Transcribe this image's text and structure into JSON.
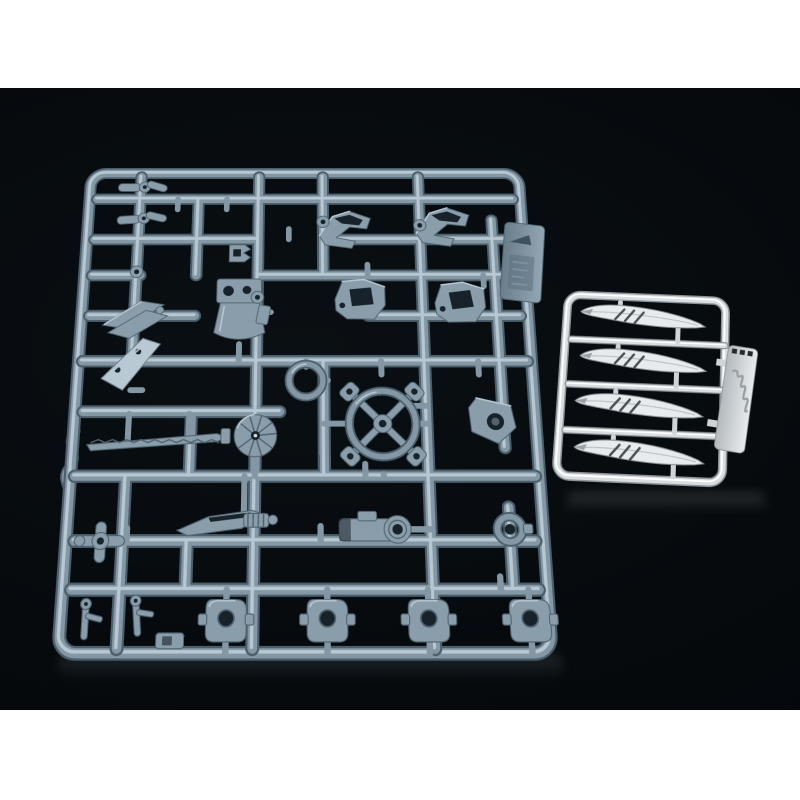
{
  "scene": {
    "subject": "plastic model kit runner sprues photographed on a glossy black backdrop",
    "setting": "black photo area framed by white page background"
  },
  "colors": {
    "page_white": "#ffffff",
    "backdrop_black": "#05090c",
    "rail_shadow": "#4b5e6b",
    "rail_base": "#8497a5",
    "rail_light": "#b8c8d3",
    "part_base": "#8a9dab",
    "part_recess": "#17222b",
    "part_bright": "#b9c9d4",
    "chrome_shadow": "#8b9298",
    "chrome_base": "#d8dde0",
    "chrome_light": "#ffffff"
  },
  "main_runner": {
    "label": "large gray runner of mecha weapon and joint parts",
    "gate_tab": "molded tab with embossed arrow mark",
    "parts": [
      "elbow joint (x2)",
      "c-clip (x2)",
      "claw bracket",
      "angled armor plate",
      "cockpit pod",
      "round ring",
      "winged vent bracket (x2)",
      "boxy vent bracket (x2)",
      "four-spoke wheel",
      "eye bracket",
      "fan-pommel serrated sword",
      "short dagger blade",
      "cross pipe joint",
      "link block",
      "collar ring",
      "square base plate (x4)",
      "antenna fork (x2)"
    ]
  },
  "chrome_runner": {
    "label": "small chrome-plated runner of curved blades",
    "parts": [
      "curved feather blade (x4)"
    ],
    "tab": "chrome tab with embossed script logo (illegible)"
  }
}
